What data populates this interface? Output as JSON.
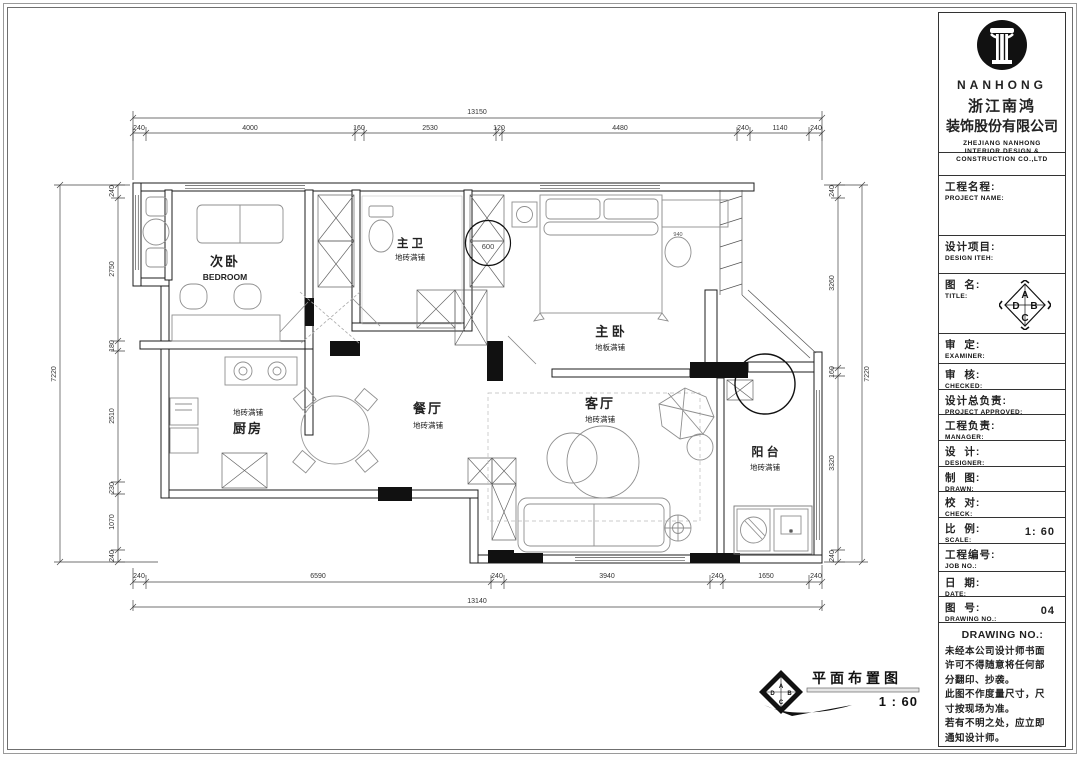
{
  "company": {
    "name_en": "NANHONG",
    "name_cn_1": "浙江南鸿",
    "name_cn_2": "装饰股份有限公司",
    "sub_en_1": "ZHEJIANG NANHONG",
    "sub_en_2": "INTERIOR DESIGN &",
    "sub_en_3": "CONSTRUCTION CO.,LTD"
  },
  "title_block": {
    "rows": [
      {
        "cn": "工程名程:",
        "en": "PROJECT NAME:",
        "value": ""
      },
      {
        "cn": "设计项目:",
        "en": "DESIGN ITEH:",
        "value": ""
      },
      {
        "cn": "图  名:",
        "en": "TITLE:",
        "value": ""
      },
      {
        "cn": "审  定:",
        "en": "EXAMINER:",
        "value": ""
      },
      {
        "cn": "审  核:",
        "en": "CHECKED:",
        "value": ""
      },
      {
        "cn": "设计总负责:",
        "en": "PROJECT APPROVED:",
        "value": ""
      },
      {
        "cn": "工程负责:",
        "en": "MANAGER:",
        "value": ""
      },
      {
        "cn": "设  计:",
        "en": "DESIGNER:",
        "value": ""
      },
      {
        "cn": "制  图:",
        "en": "DRAWN:",
        "value": ""
      },
      {
        "cn": "校  对:",
        "en": "CHECK:",
        "value": ""
      },
      {
        "cn": "比  例:",
        "en": "SCALE:",
        "value": "1: 60"
      },
      {
        "cn": "工程编号:",
        "en": "JOB  NO.:",
        "value": ""
      },
      {
        "cn": "日  期:",
        "en": "DATE:",
        "value": ""
      },
      {
        "cn": "图  号:",
        "en": "DRAWING NO.:",
        "value": "04"
      }
    ],
    "note_header": "DRAWING NO.:",
    "note_lines": [
      "未经本公司设计师书面",
      "许可不得随意将任何部",
      "分翻印、抄袭。",
      "此图不作度量尺寸，尺",
      "寸按现场为准。",
      "若有不明之处，应立即",
      "通知设计师。"
    ]
  },
  "plan": {
    "rooms": [
      {
        "name": "次卧",
        "sub": "BEDROOM"
      },
      {
        "name": "主 卫",
        "sub": "地砖满铺"
      },
      {
        "name": "主 卧",
        "sub": "地板满铺"
      },
      {
        "name": "餐厅",
        "sub": "地砖满铺"
      },
      {
        "name": "厨房",
        "sub": "地砖满铺"
      },
      {
        "name": "客厅",
        "sub": "地砖满铺"
      },
      {
        "name": "阳 台",
        "sub": "地砖满铺"
      }
    ],
    "annotations": {
      "shower_circle": "600",
      "desk": "940"
    },
    "caption": {
      "title": "平面布置图",
      "scale": "1 : 60"
    },
    "compass": {
      "n": "A",
      "e": "B",
      "s": "C",
      "w": "D"
    },
    "dims": {
      "top": {
        "overall": "13150",
        "segments": [
          "240",
          "4000",
          "160",
          "2530",
          "120",
          "4480",
          "240",
          "1140",
          "240"
        ]
      },
      "bottom": {
        "overall": "13140",
        "segments": [
          "240",
          "6590",
          "240",
          "3940",
          "240",
          "1650",
          "240"
        ]
      },
      "left": {
        "overall": "7220",
        "segments": [
          "240",
          "2750",
          "180",
          "2510",
          "230",
          "1070",
          "240"
        ]
      },
      "right": {
        "overall": "7220",
        "segments": [
          "240",
          "3260",
          "160",
          "3320",
          "240"
        ]
      }
    }
  }
}
